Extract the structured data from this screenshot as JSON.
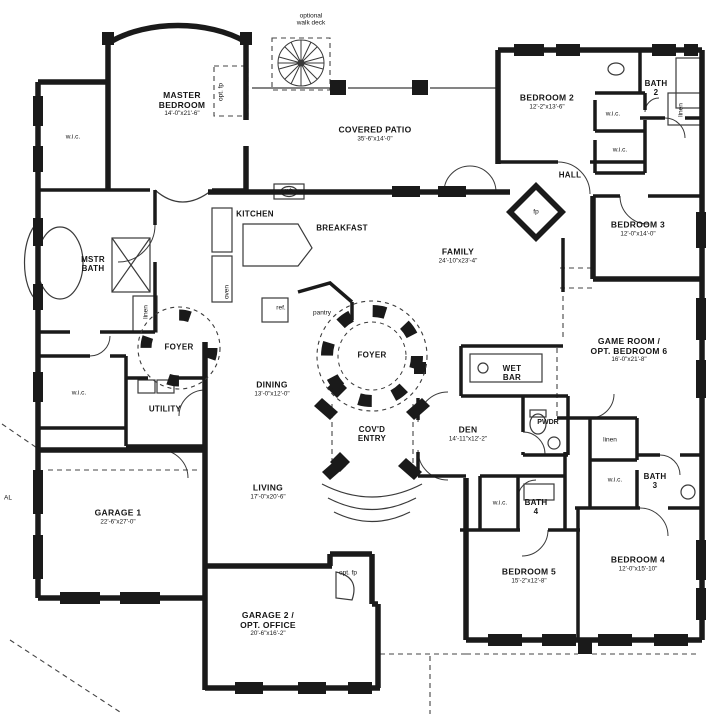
{
  "rooms": {
    "master_bedroom": {
      "label": "MASTER",
      "label2": "BEDROOM",
      "dims": "14'-0\"x21'-6\""
    },
    "covered_patio": {
      "label": "COVERED PATIO",
      "dims": "35'-6\"x14'-0\""
    },
    "bedroom_2": {
      "label": "BEDROOM 2",
      "dims": "12'-2\"x13'-6\""
    },
    "bedroom_3": {
      "label": "BEDROOM 3",
      "dims": "12'-0\"x14'-0\""
    },
    "bedroom_4": {
      "label": "BEDROOM 4",
      "dims": "12'-0\"x15'-10\""
    },
    "bedroom_5": {
      "label": "BEDROOM 5",
      "dims": "15'-2\"x12'-8\""
    },
    "family": {
      "label": "FAMILY",
      "dims": "24'-10\"x23'-4\""
    },
    "kitchen": {
      "label": "KITCHEN"
    },
    "breakfast": {
      "label": "BREAKFAST"
    },
    "dining": {
      "label": "DINING",
      "dims": "13'-0\"x12'-0\""
    },
    "living": {
      "label": "LIVING",
      "dims": "17'-0\"x20'-6\""
    },
    "den": {
      "label": "DEN",
      "dims": "14'-11\"x12'-2\""
    },
    "game_room": {
      "label": "GAME ROOM /",
      "label2": "OPT. BEDROOM 6",
      "dims": "16'-0\"x21'-8\""
    },
    "garage_1": {
      "label": "GARAGE 1",
      "dims": "22'-6\"x27'-0\""
    },
    "garage_2": {
      "label": "GARAGE 2 /",
      "label2": "OPT. OFFICE",
      "dims": "20'-6\"x16'-2\""
    },
    "mstr_bath": {
      "label": "MSTR",
      "label2": "BATH"
    },
    "foyer_west": {
      "label": "FOYER"
    },
    "foyer_east": {
      "label": "FOYER"
    },
    "covd_entry": {
      "label": "COV'D",
      "label2": "ENTRY"
    },
    "utility": {
      "label": "UTILITY"
    },
    "hall": {
      "label": "HALL"
    },
    "wet_bar": {
      "label": "WET",
      "label2": "BAR"
    },
    "pwdr": {
      "label": "PWDR"
    },
    "bath_2": {
      "label": "BATH",
      "label2": "2"
    },
    "bath_3": {
      "label": "BATH",
      "label2": "3"
    },
    "bath_4": {
      "label": "BATH",
      "label2": "4"
    }
  },
  "closets": {
    "wic": "w.i.c.",
    "linen": "linen"
  },
  "fixtures": {
    "fp": "fp",
    "opt_fp": "opt. fp",
    "wb": "wb",
    "oven": "oven",
    "ref": "ref.",
    "pantry": "pantry"
  },
  "annotations": {
    "walk_deck_line1": "optional",
    "walk_deck_line2": "walk deck",
    "edge_text": "AL"
  },
  "colors": {
    "wall": "#1a1a1a",
    "thin_line": "#3a3a3a",
    "background": "#ffffff"
  }
}
